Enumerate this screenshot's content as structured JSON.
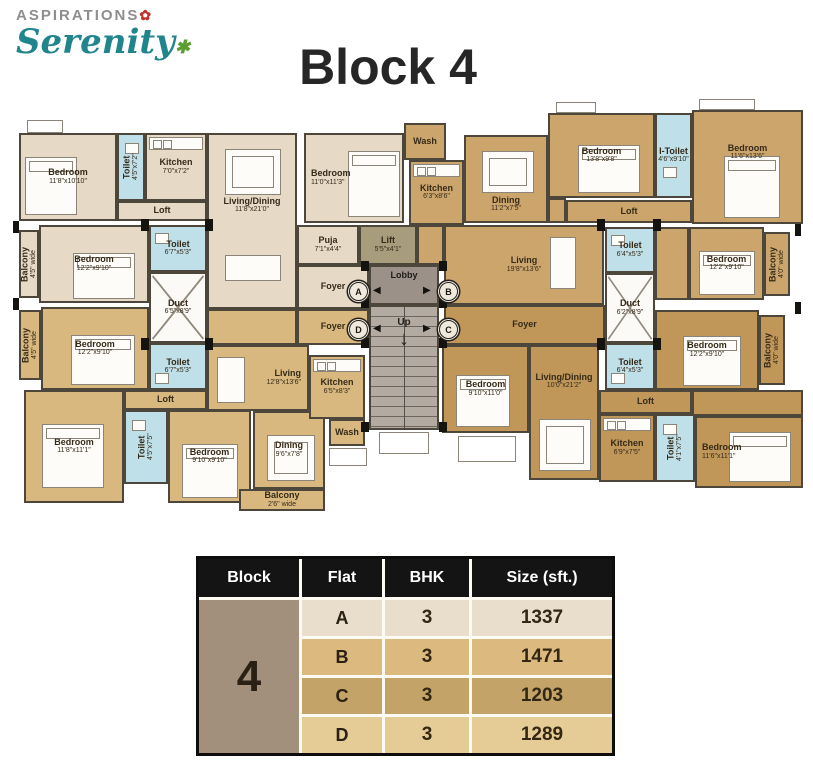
{
  "header": {
    "brand_top": "ASPIRATIONS",
    "brand_main": "Serenity",
    "title": "Block 4"
  },
  "icons": {
    "flower": "✿",
    "leaf": "✱",
    "arrow_left": "◀",
    "arrow_right": "▶",
    "down_arrow": "↓"
  },
  "plan": {
    "markers": {
      "a": "A",
      "b": "B",
      "c": "C",
      "d": "D"
    },
    "rooms": {
      "a_bed1": {
        "name": "Bedroom",
        "dims": "11'8\"x10'10\""
      },
      "a_toilet1": {
        "name": "Toilet",
        "dims": "4'5\"x7'2\""
      },
      "a_kitchen": {
        "name": "Kitchen",
        "dims": "7'0\"x7'2\""
      },
      "a_loft": {
        "name": "Loft"
      },
      "a_living": {
        "name": "Living/Dining",
        "dims": "11'8\"x21'0\""
      },
      "a_bed2": {
        "name": "Bedroom",
        "dims": "11'0\"x11'3\""
      },
      "a_puja": {
        "name": "Puja",
        "dims": "7'1\"x4'4\""
      },
      "a_foyer": {
        "name": "Foyer"
      },
      "a_bed3": {
        "name": "Bedroom",
        "dims": "12'2\"x9'10\""
      },
      "a_balcony": {
        "name": "Balcony",
        "dims": "4'5\" wide"
      },
      "a_toilet2": {
        "name": "Toilet",
        "dims": "6'7\"x5'3\""
      },
      "duct_left": {
        "name": "Duct",
        "dims": "6'5\"x8'9\""
      },
      "duct_right": {
        "name": "Duct",
        "dims": "6'2\"x8'9\""
      },
      "lift": {
        "name": "Lift",
        "dims": "5'5\"x4'1\""
      },
      "lobby": {
        "name": "Lobby"
      },
      "stairs": {
        "name": "Up"
      },
      "b_wash": {
        "name": "Wash"
      },
      "b_kitchen": {
        "name": "Kitchen",
        "dims": "6'3\"x8'6\""
      },
      "b_dining": {
        "name": "Dining",
        "dims": "11'2\"x7'5\""
      },
      "b_bed1": {
        "name": "Bedroom",
        "dims": "13'8\"x9'8\""
      },
      "b_itoilet": {
        "name": "I-Toilet",
        "dims": "4'6\"x9'10\""
      },
      "b_bed2": {
        "name": "Bedroom",
        "dims": "11'6\"x13'6\""
      },
      "b_loft": {
        "name": "Loft"
      },
      "b_toilet2": {
        "name": "Toilet",
        "dims": "6'4\"x5'3\""
      },
      "b_bed3": {
        "name": "Bedroom",
        "dims": "12'2\"x9'10\""
      },
      "b_balcony": {
        "name": "Balcony",
        "dims": "4'0\" wide"
      },
      "b_living": {
        "name": "Living",
        "dims": "19'8\"x13'6\""
      },
      "c_foyer": {
        "name": "Foyer"
      },
      "c_toilet1": {
        "name": "Toilet",
        "dims": "6'4\"x5'3\""
      },
      "c_bed1": {
        "name": "Bedroom",
        "dims": "9'10\"x11'0\""
      },
      "c_bed2": {
        "name": "Bedroom",
        "dims": "12'2\"x9'10\""
      },
      "c_balcony": {
        "name": "Balcony",
        "dims": "4'0\" wide"
      },
      "c_living": {
        "name": "Living/Dining",
        "dims": "10'0\"x21'2\""
      },
      "c_loft": {
        "name": "Loft"
      },
      "c_kitchen": {
        "name": "Kitchen",
        "dims": "6'9\"x7'5\""
      },
      "c_toilet2": {
        "name": "Toilet",
        "dims": "4'1\"x7'5\""
      },
      "c_bed3": {
        "name": "Bedroom",
        "dims": "11'6\"x11'1\""
      },
      "d_foyer": {
        "name": "Foyer"
      },
      "d_bed1": {
        "name": "Bedroom",
        "dims": "12'2\"x9'10\""
      },
      "d_balcony1": {
        "name": "Balcony",
        "dims": "4'5\" wide"
      },
      "d_toilet1": {
        "name": "Toilet",
        "dims": "6'7\"x5'3\""
      },
      "d_loft": {
        "name": "Loft"
      },
      "d_bed2": {
        "name": "Bedroom",
        "dims": "11'8\"x11'1\""
      },
      "d_toilet2": {
        "name": "Toilet",
        "dims": "4'5\"x7'5\""
      },
      "d_bed3": {
        "name": "Bedroom",
        "dims": "9'10\"x9'10\""
      },
      "d_living": {
        "name": "Living",
        "dims": "12'8\"x13'6\""
      },
      "d_dining": {
        "name": "Dining",
        "dims": "9'6\"x7'8\""
      },
      "d_kitchen": {
        "name": "Kitchen",
        "dims": "6'5\"x8'3\""
      },
      "d_wash": {
        "name": "Wash"
      },
      "d_balcony2": {
        "name": "Balcony",
        "dims": "2'6\" wide"
      }
    }
  },
  "table": {
    "headers": [
      "Block",
      "Flat",
      "BHK",
      "Size (sft.)"
    ],
    "block": "4",
    "rows": [
      {
        "flat": "A",
        "bhk": "3",
        "size": "1337"
      },
      {
        "flat": "B",
        "bhk": "3",
        "size": "1471"
      },
      {
        "flat": "C",
        "bhk": "3",
        "size": "1203"
      },
      {
        "flat": "D",
        "bhk": "3",
        "size": "1289"
      }
    ]
  },
  "colors": {
    "flat_a": "#e6d9c6",
    "flat_b": "#cba56c",
    "flat_c": "#c09759",
    "flat_d": "#d8b87f",
    "toilet": "#bfdfe9",
    "accent_red": "#c2342a",
    "brand_teal": "#20858d"
  }
}
